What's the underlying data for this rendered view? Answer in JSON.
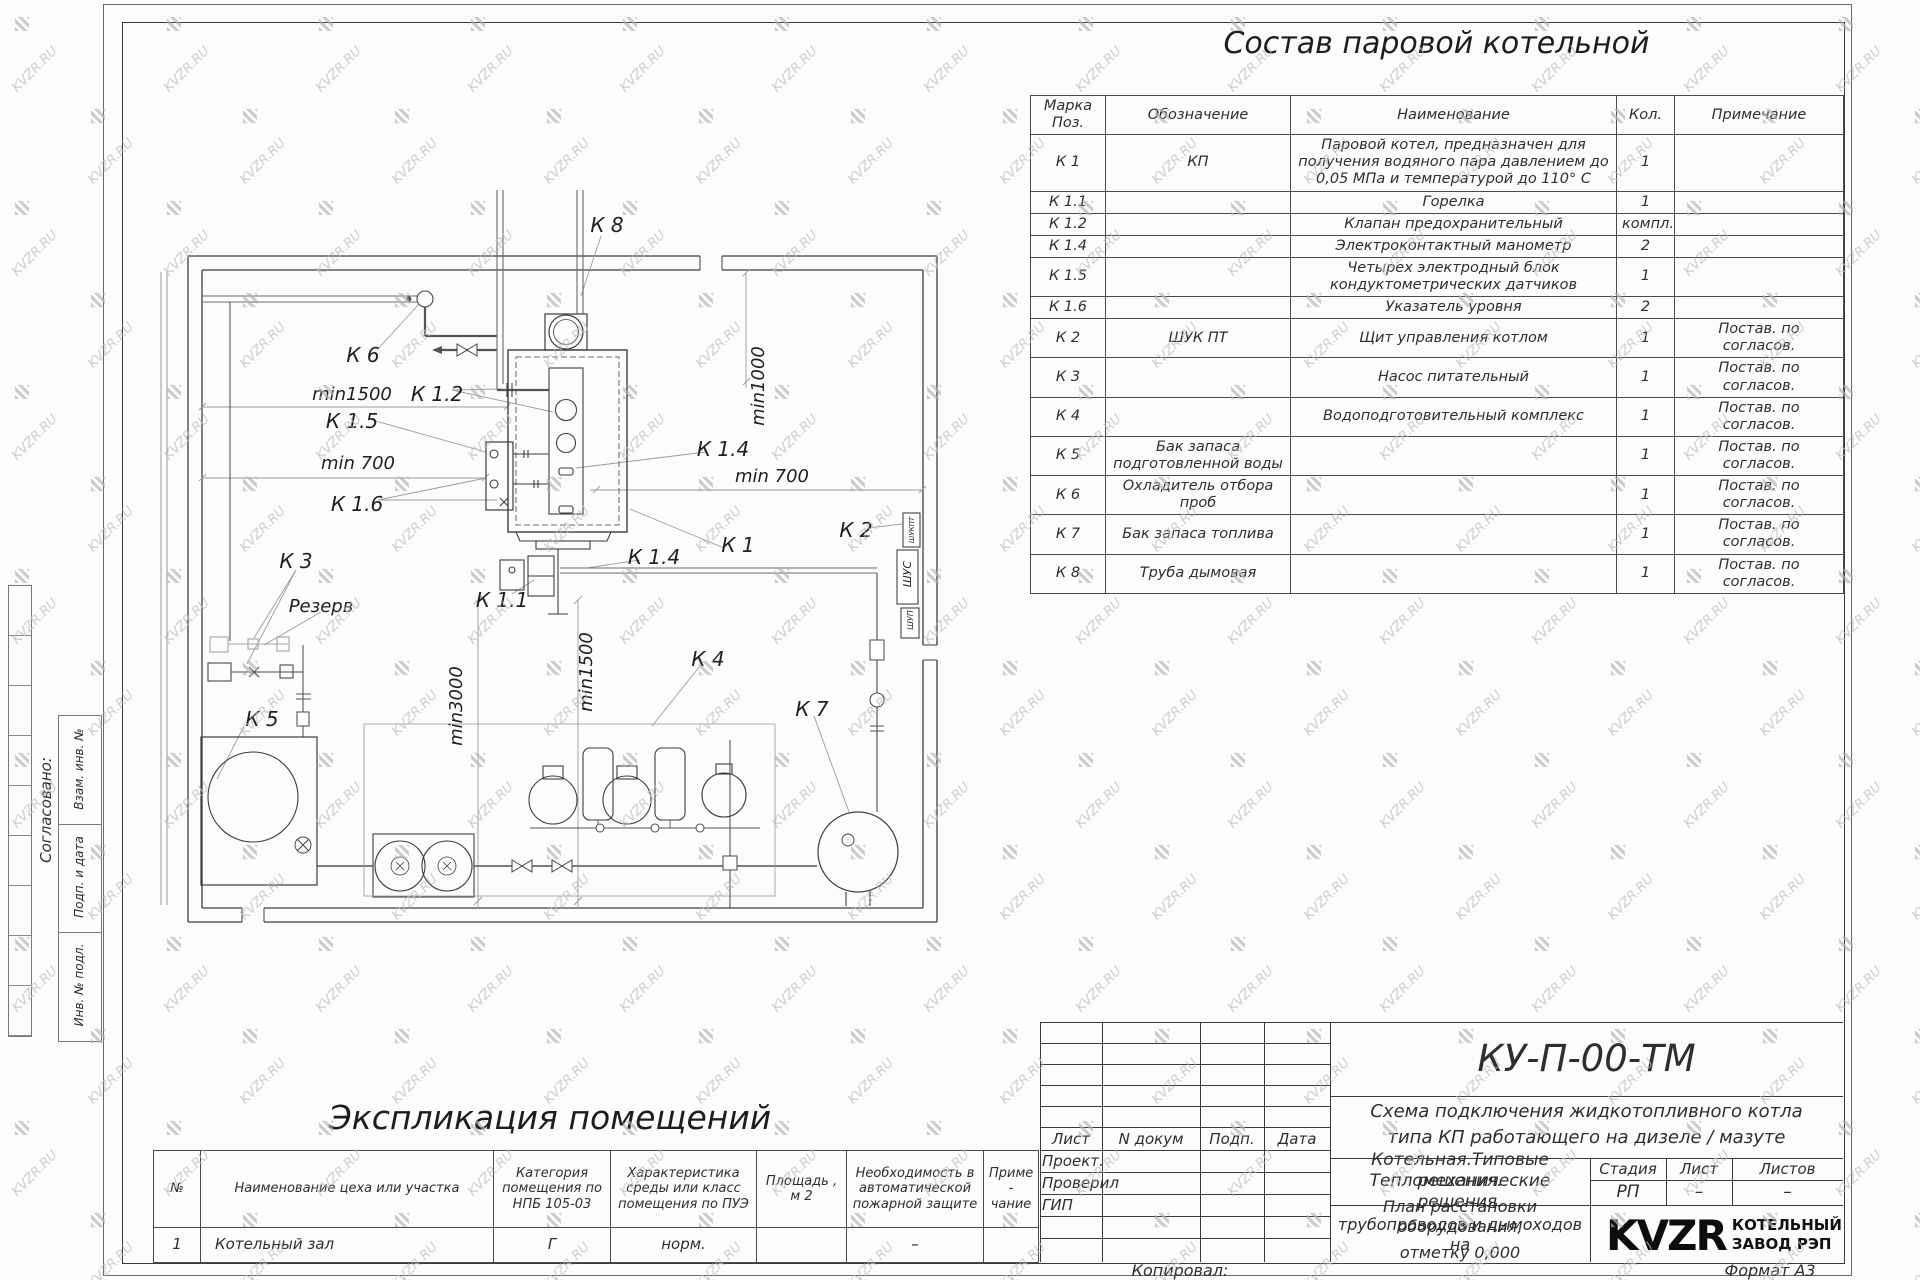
{
  "watermark": {
    "text": "KVZR.RU"
  },
  "sheet": {
    "left_margin": {
      "approved_label": "Согласовано:",
      "stamps": [
        "Взам. инв. №",
        "Подп. и дата",
        "Инв. № подл."
      ]
    }
  },
  "equipment_table": {
    "title": "Состав паровой котельной",
    "headers": [
      "Марка\nПоз.",
      "Обозначение",
      "Наименование",
      "Кол.",
      "Примечание"
    ],
    "rows": [
      {
        "mark": "К 1",
        "designation": "КП",
        "name": "Паровой котел, предназначен для получения водяного пара давлением до 0,05 МПа и температурой до 110° С",
        "qty": "1",
        "note": ""
      },
      {
        "mark": "К 1.1",
        "designation": "",
        "name": "Горелка",
        "qty": "1",
        "note": ""
      },
      {
        "mark": "К 1.2",
        "designation": "",
        "name": "Клапан предохранительный",
        "qty": "компл.",
        "note": ""
      },
      {
        "mark": "К 1.4",
        "designation": "",
        "name": "Электроконтактный манометр",
        "qty": "2",
        "note": ""
      },
      {
        "mark": "К 1.5",
        "designation": "",
        "name": "Четырех электродный блок кондуктометрических датчиков",
        "qty": "1",
        "note": ""
      },
      {
        "mark": "К 1.6",
        "designation": "",
        "name": "Указатель уровня",
        "qty": "2",
        "note": ""
      },
      {
        "mark": "К 2",
        "designation": "ШУК ПТ",
        "name": "Щит управления котлом",
        "qty": "1",
        "note": "Постав. по согласов."
      },
      {
        "mark": "К 3",
        "designation": "",
        "name": "Насос питательный",
        "qty": "1",
        "note": "Постав. по согласов."
      },
      {
        "mark": "К 4",
        "designation": "",
        "name": "Водоподготовительный комплекс",
        "qty": "1",
        "note": "Постав. по согласов."
      },
      {
        "mark": "К 5",
        "designation": "Бак запаса подготовленной воды",
        "name": "",
        "qty": "1",
        "note": "Постав. по согласов."
      },
      {
        "mark": "К 6",
        "designation": "Охладитель отбора проб",
        "name": "",
        "qty": "1",
        "note": "Постав. по согласов."
      },
      {
        "mark": "К 7",
        "designation": "Бак запаса топлива",
        "name": "",
        "qty": "1",
        "note": "Постав. по согласов."
      },
      {
        "mark": "К 8",
        "designation": "Труба дымовая",
        "name": "",
        "qty": "1",
        "note": "Постав. по согласов."
      }
    ]
  },
  "explication_table": {
    "title": "Экспликация помещений",
    "headers": [
      "№",
      "Наименование цеха или участка",
      "Категория помещения по НПБ 105-03",
      "Характеристика среды или класс помещения по ПУЭ",
      "Площадь ,\nм 2",
      "Необходимость в автоматической пожарной защите",
      "Приме -\nчание"
    ],
    "row": {
      "num": "1",
      "name": "Котельный зал",
      "category": "Г",
      "characteristic": "норм.",
      "area": "",
      "fire": "–",
      "note": ""
    }
  },
  "plan": {
    "labels": [
      {
        "text": "К 8"
      },
      {
        "text": "К 6"
      },
      {
        "text": "min1500"
      },
      {
        "text": "К 1.2"
      },
      {
        "text": "К 1.5"
      },
      {
        "text": "min 700"
      },
      {
        "text": "К 1.6"
      },
      {
        "text": "min1000"
      },
      {
        "text": "К 1.4"
      },
      {
        "text": "min 700"
      },
      {
        "text": "К 1"
      },
      {
        "text": "К 1.4"
      },
      {
        "text": "К 2"
      },
      {
        "text": "К 3"
      },
      {
        "text": "Резерв"
      },
      {
        "text": "К 1.1"
      },
      {
        "text": "min3000"
      },
      {
        "text": "min1500"
      },
      {
        "text": "К 4"
      },
      {
        "text": "К 5"
      },
      {
        "text": "К 7"
      }
    ],
    "cabinets": [
      "ШУКПТ",
      "ШУС",
      "ШУП"
    ]
  },
  "title_block": {
    "doc_number": "КУ-П-00-ТМ",
    "subtitle_line1": "Схема подключения жидкотопливного котла",
    "subtitle_line2": "типа КП работающего на дизеле / мазуте",
    "rev_headers": [
      "Лист",
      "N докум",
      "Подп.",
      "Дата"
    ],
    "roles": [
      "Проект.",
      "Проверил",
      "ГИП"
    ],
    "object_line1": "Котельная.Типовые решения.",
    "object_line2": "Тепломеханические решения.",
    "stage_header": "Стадия",
    "sheet_header": "Лист",
    "sheets_header": "Листов",
    "stage_value": "РП",
    "sheet_value": "–",
    "sheets_value": "–",
    "plan_line1": "План расстановки оборудования,",
    "plan_line2": "трубопроводов и дымоходов на",
    "plan_line3": "отметку 0,000",
    "logo_text": "KVZR",
    "company_line1": "КОТЕЛЬНЫЙ",
    "company_line2": "ЗАВОД РЭП",
    "copied_label": "Копировал:",
    "format_label": "Формат А3"
  }
}
